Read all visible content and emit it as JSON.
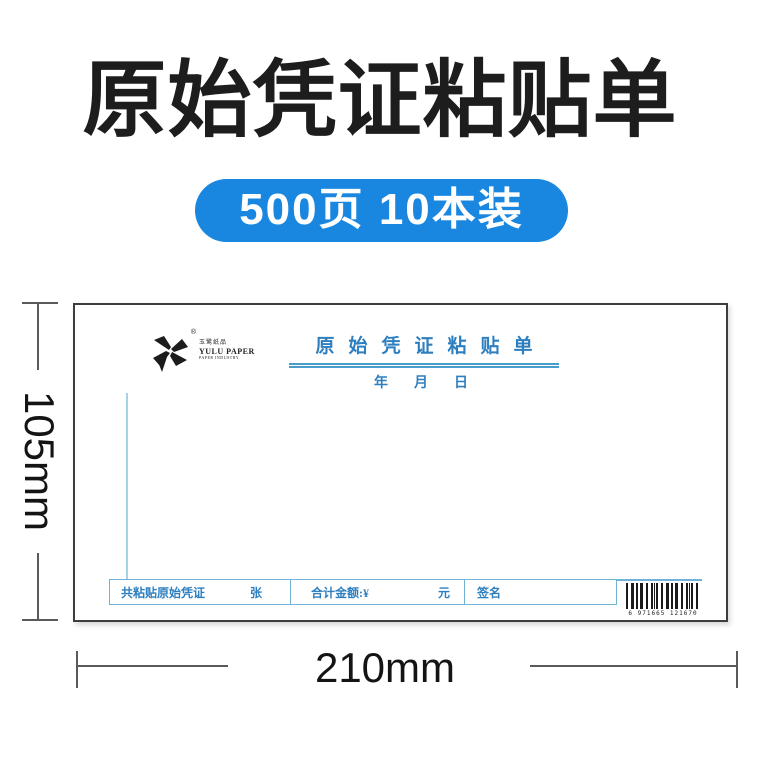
{
  "header": {
    "title": "原始凭证粘贴单",
    "badge": "500页 10本装"
  },
  "dimensions": {
    "height": "105mm",
    "width": "210mm"
  },
  "paper": {
    "brand": {
      "cn": "玉鹭纸品",
      "en": "YULU PAPER",
      "sub": "PAPER INDUSTRY",
      "registered": "®"
    },
    "form_title": "原始凭证粘贴单",
    "date_line": "年　月　日",
    "footer": {
      "pasted_label": "共粘贴原始凭证",
      "pasted_unit": "张",
      "amount_label": "合计金额:¥",
      "amount_unit": "元",
      "sign_label": "签名"
    },
    "barcode_digits": "6 971665 121670"
  },
  "colors": {
    "badge_blue": "#1987E0",
    "form_blue": "#2E7FC0",
    "table_border_blue": "#6FB3D9",
    "paste_line_blue": "#A5D5E5"
  }
}
